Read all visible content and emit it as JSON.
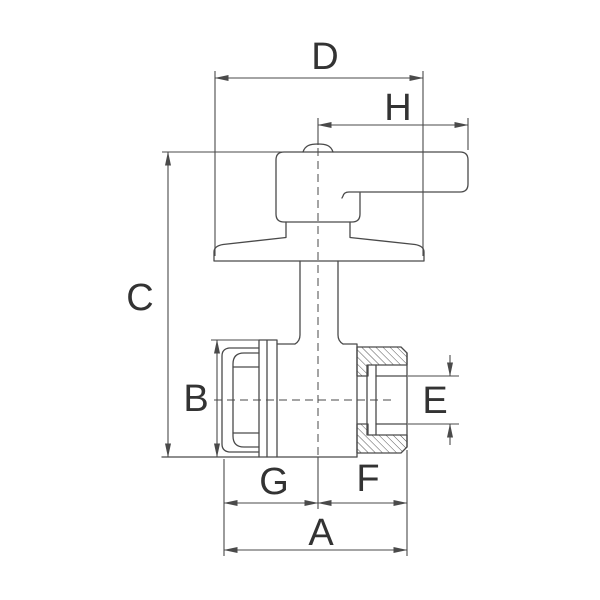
{
  "drawing": {
    "title": "Ball valve with lever handle - dimensioned technical drawing",
    "background": "#ffffff",
    "line_color": "#4a4a4a",
    "label_color": "#333333",
    "hatch_style": "diagonal section hatching on male threaded outlet"
  },
  "labels": {
    "A": "A",
    "B": "B",
    "C": "C",
    "D": "D",
    "E": "E",
    "F": "F",
    "G": "G",
    "H": "H"
  },
  "dimensions": [
    {
      "label": "D",
      "orientation": "horizontal",
      "measures": "base flange width (top dimension)"
    },
    {
      "label": "H",
      "orientation": "horizontal",
      "measures": "centerline to handle end"
    },
    {
      "label": "C",
      "orientation": "vertical",
      "measures": "overall height, handle top to body bottom"
    },
    {
      "label": "B",
      "orientation": "vertical",
      "measures": "union nut / body diameter"
    },
    {
      "label": "E",
      "orientation": "vertical",
      "measures": "male outlet bore diameter"
    },
    {
      "label": "G",
      "orientation": "horizontal",
      "measures": "left face to vertical centerline"
    },
    {
      "label": "F",
      "orientation": "horizontal",
      "measures": "vertical centerline to male thread end"
    },
    {
      "label": "A",
      "orientation": "horizontal",
      "measures": "overall length (G plus F)"
    }
  ]
}
